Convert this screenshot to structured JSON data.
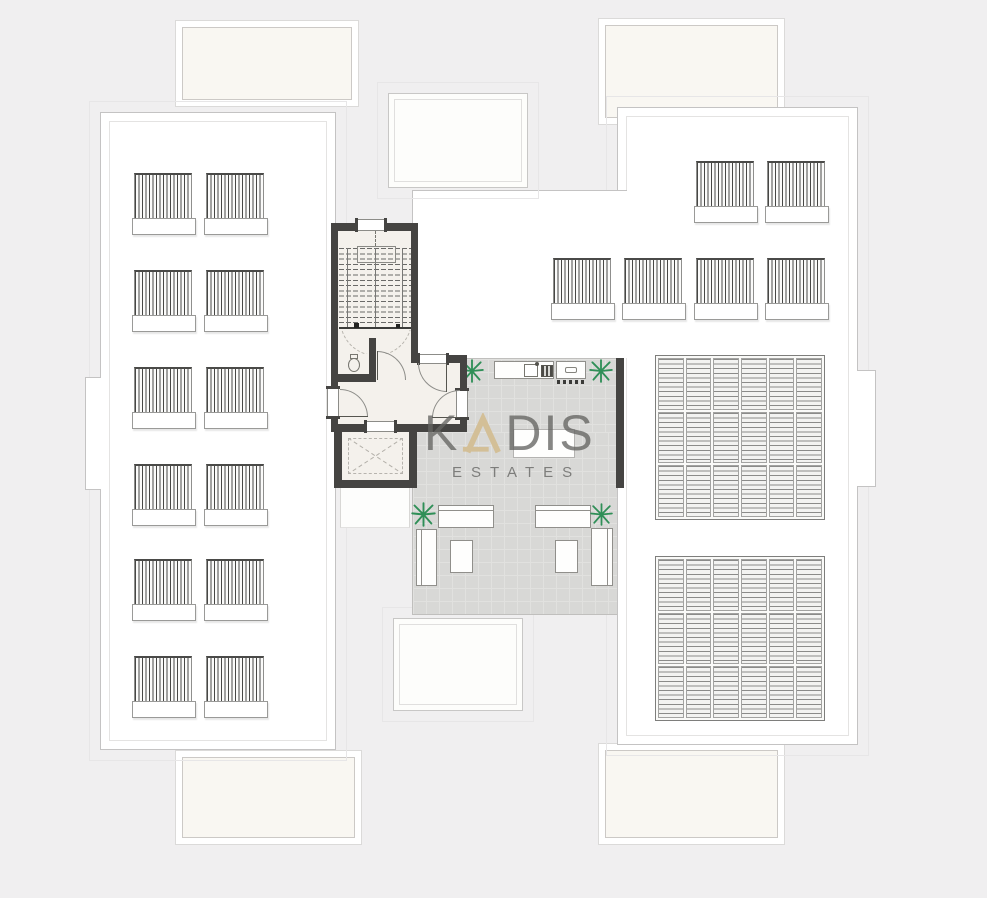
{
  "watermark": {
    "k": "K",
    "dis": "DIS",
    "subtitle": "ESTATES",
    "accent_color": "#d3bf97",
    "text_color": "#64625e"
  },
  "palette": {
    "background": "#f0eff0",
    "roof_white": "#ffffff",
    "balcony_fill": "#f9f7f2",
    "wall_dark": "#454442",
    "terrace_tile": "#d8d8d6",
    "plant_green": "#2f8f57",
    "outline_gray": "#c4c3c3"
  },
  "plan": {
    "type": "penthouse-roof-floor-plan",
    "left_wing": {
      "pergola_units": 12,
      "pergola_rows": 6,
      "pergola_cols": 2
    },
    "right_wing": {
      "pergola_units": 6,
      "louvre_decks": 2
    },
    "core_rooms": [
      "staircase",
      "wc",
      "hallway",
      "elevator"
    ],
    "terrace_features": [
      "outdoor-kitchen-counter",
      "sink",
      "grill",
      "bbq-unit",
      "kitchen-island",
      "sofa-group-left",
      "sofa-group-right",
      "coffee-table-left",
      "coffee-table-right",
      "plants"
    ]
  }
}
